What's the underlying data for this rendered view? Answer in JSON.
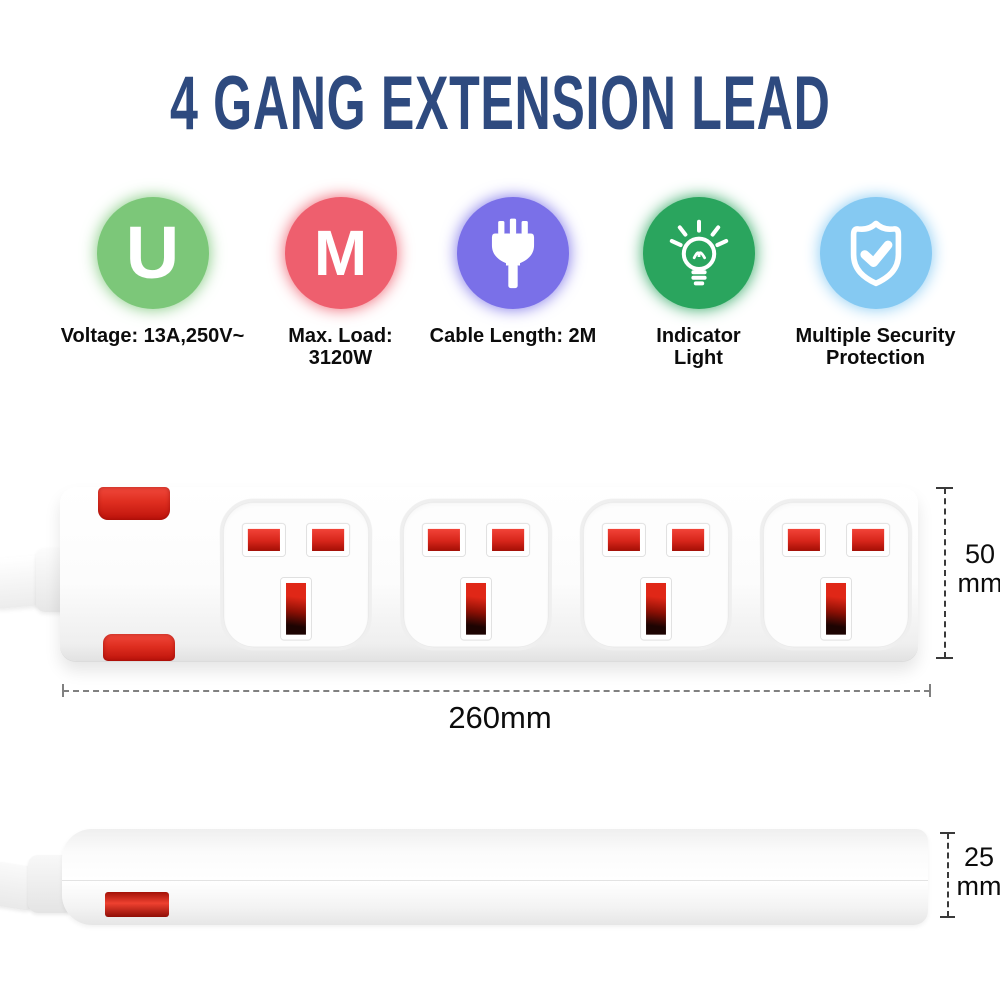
{
  "title": {
    "text": "4 GANG EXTENSION LEAD",
    "color": "#2e4a7f"
  },
  "features": [
    {
      "name": "voltage",
      "icon": "u-letter-icon",
      "circle_color": "#7cc779",
      "glyph": "U",
      "lines": [
        "Voltage: 13A,250V~",
        ""
      ]
    },
    {
      "name": "max-load",
      "icon": "m-letter-icon",
      "circle_color": "#ee5f6e",
      "glyph": "M",
      "lines": [
        "Max. Load:",
        "3120W"
      ]
    },
    {
      "name": "cable-length",
      "icon": "plug-icon",
      "circle_color": "#7a70e8",
      "lines": [
        "Cable Length: 2M",
        ""
      ]
    },
    {
      "name": "indicator-light",
      "icon": "bulb-icon",
      "circle_color": "#2aa55e",
      "lines": [
        "Indicator",
        "Light"
      ]
    },
    {
      "name": "security-protection",
      "icon": "shield-check-icon",
      "circle_color": "#85c9f2",
      "lines": [
        "Multiple Security",
        "Protection"
      ]
    }
  ],
  "product": {
    "socket_count": 4,
    "body_color": "#ffffff",
    "accent_red": "#e2251a"
  },
  "dimensions": {
    "width": {
      "value": "260mm"
    },
    "height": {
      "value": "50",
      "unit": "mm"
    },
    "depth": {
      "value": "25",
      "unit": "mm"
    }
  }
}
